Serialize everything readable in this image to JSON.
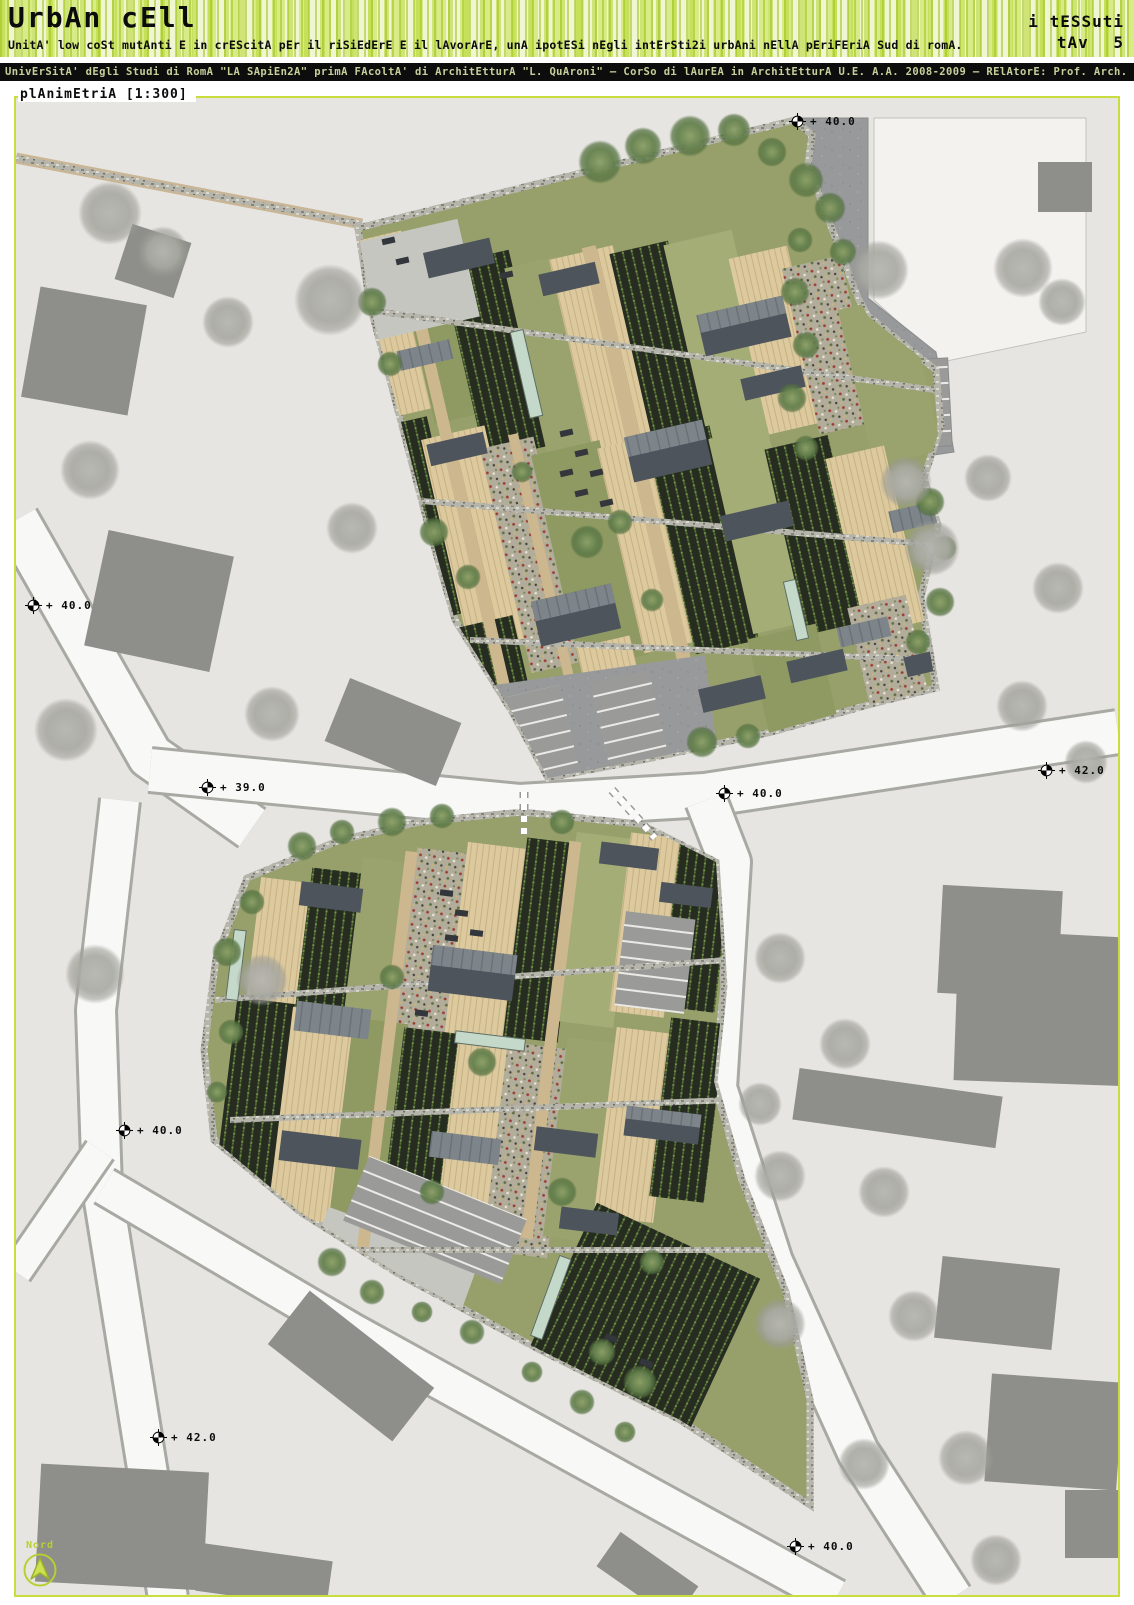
{
  "header": {
    "title": "UrbAn cEll",
    "subtitle": "UnitA' low coSt mutAnti E in crEScitA pEr il riSiEdErE E il lAvorArE, unA ipotESi nEgli intErSti2i urbAni nEllA pEriFEriA Sud di romA.",
    "series_label": "i tESSuti",
    "sheet_label": "tAv 5",
    "credits": "UnivErSitA' dEgli Studi di RomA \"LA SApiEn2A\" primA FAcoltA' di ArchitEtturA \"L. QuAroni\" – CorSo di lAurEA in ArchitEtturA U.E. A.A. 2008-2009 – RElAtorE: Prof. Arch. Antonino SAggio – LAurEAndA: VAlEntinA PEnnAcchi"
  },
  "plan": {
    "caption": "plAnimEtriA [1:300]",
    "north_label": "Nord",
    "markers": [
      {
        "label": "+ 40.0"
      },
      {
        "label": "+ 40.0"
      },
      {
        "label": "+ 39.0"
      },
      {
        "label": "+ 40.0"
      },
      {
        "label": "+ 42.0"
      },
      {
        "label": "+ 40.0"
      },
      {
        "label": "+ 42.0"
      },
      {
        "label": "+ 40.0"
      }
    ]
  },
  "icons": {
    "survey_marker": "quartered-circle-crosshair",
    "north_arrow": "triangle-up-in-circle"
  },
  "colors": {
    "accent_green": "#c9dd3c",
    "stripe_green": "#cde25f",
    "bar_background": "#0d0d0d",
    "bar_text": "#c7d09b",
    "map_background": "#e7e5e1",
    "field_green": "#97a06b",
    "crop_dark": "#272c21",
    "building_dark": "#4d545c",
    "context_gray": "#8e8e8a"
  }
}
